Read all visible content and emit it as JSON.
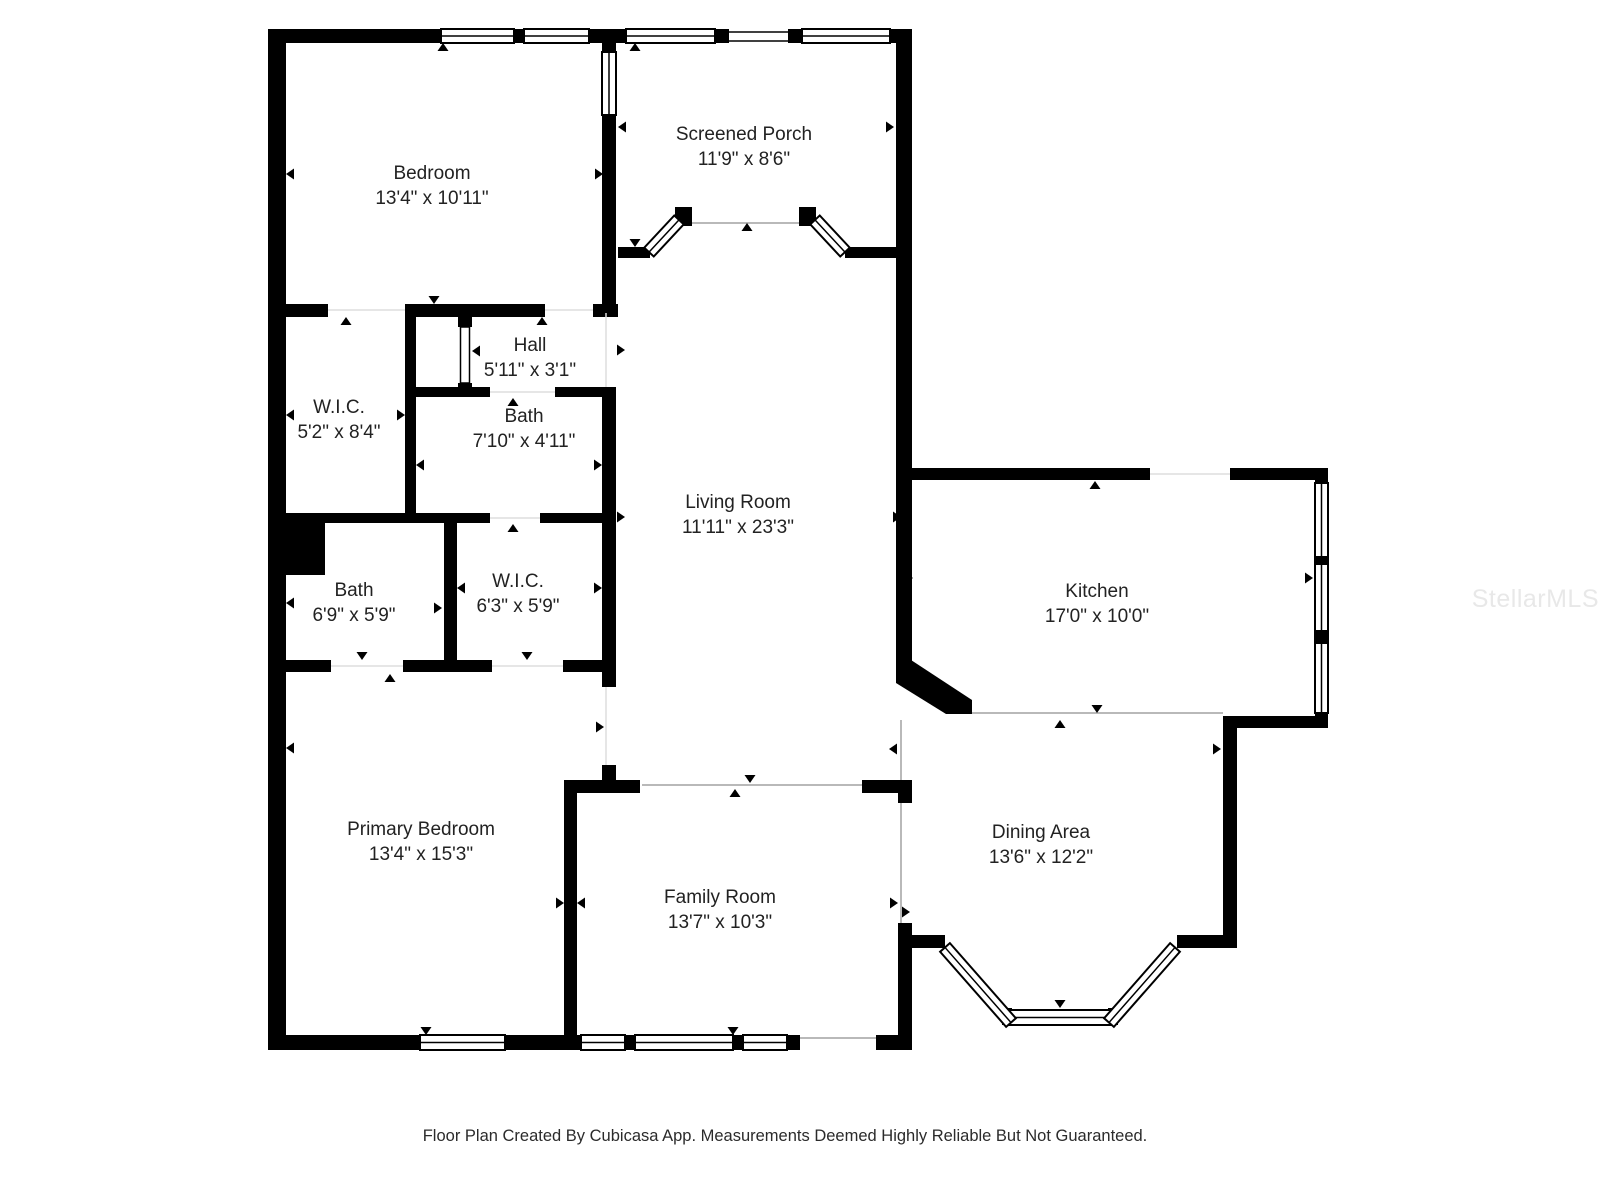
{
  "footer": {
    "text": "Floor Plan Created By Cubicasa App. Measurements Deemed Highly Reliable But Not Guaranteed."
  },
  "watermark": {
    "text": "StellarMLS"
  },
  "rooms": [
    {
      "slug": "bedroom",
      "name": "Bedroom",
      "dims": "13'4\" x 10'11\"",
      "x": 432,
      "y": 186
    },
    {
      "slug": "screened-porch",
      "name": "Screened Porch",
      "dims": "11'9\" x 8'6\"",
      "x": 744,
      "y": 147
    },
    {
      "slug": "hall",
      "name": "Hall",
      "dims": "5'11\" x 3'1\"",
      "x": 530,
      "y": 358
    },
    {
      "slug": "bath-upper",
      "name": "Bath",
      "dims": "7'10\" x 4'11\"",
      "x": 524,
      "y": 429
    },
    {
      "slug": "wic-upper",
      "name": "W.I.C.",
      "dims": "5'2\" x 8'4\"",
      "x": 339,
      "y": 420
    },
    {
      "slug": "living-room",
      "name": "Living Room",
      "dims": "11'11\" x 23'3\"",
      "x": 738,
      "y": 515
    },
    {
      "slug": "kitchen",
      "name": "Kitchen",
      "dims": "17'0\" x 10'0\"",
      "x": 1097,
      "y": 604
    },
    {
      "slug": "bath-lower",
      "name": "Bath",
      "dims": "6'9\" x 5'9\"",
      "x": 354,
      "y": 603
    },
    {
      "slug": "wic-lower",
      "name": "W.I.C.",
      "dims": "6'3\" x 5'9\"",
      "x": 518,
      "y": 594
    },
    {
      "slug": "primary-bedroom",
      "name": "Primary Bedroom",
      "dims": "13'4\" x 15'3\"",
      "x": 421,
      "y": 842
    },
    {
      "slug": "family-room",
      "name": "Family Room",
      "dims": "13'7\" x 10'3\"",
      "x": 720,
      "y": 910
    },
    {
      "slug": "dining-area",
      "name": "Dining Area",
      "dims": "13'6\" x 12'2\"",
      "x": 1041,
      "y": 845
    }
  ],
  "floorplan": {
    "colors": {
      "wall": "#000000",
      "open": "#b9b9b9",
      "thr": "#dedede"
    },
    "walls": [
      [
        268,
        29,
        18,
        1021
      ],
      [
        273,
        29,
        168,
        14
      ],
      [
        514,
        29,
        10,
        14
      ],
      [
        589,
        29,
        29,
        14
      ],
      [
        618,
        29,
        8,
        14
      ],
      [
        715,
        29,
        14,
        14
      ],
      [
        788,
        29,
        14,
        14
      ],
      [
        890,
        29,
        22,
        14
      ],
      [
        896,
        29,
        16,
        640
      ],
      [
        896,
        468,
        254,
        12
      ],
      [
        1230,
        468,
        98,
        12
      ],
      [
        1315,
        468,
        13,
        15
      ],
      [
        1315,
        713,
        13,
        15
      ],
      [
        1223,
        716,
        105,
        12
      ],
      [
        1223,
        716,
        14,
        232
      ],
      [
        1177,
        935,
        60,
        13
      ],
      [
        898,
        935,
        47,
        13
      ],
      [
        1002,
        1008,
        10,
        17
      ],
      [
        1108,
        1008,
        10,
        17
      ],
      [
        898,
        923,
        14,
        127
      ],
      [
        876,
        1035,
        36,
        15
      ],
      [
        268,
        1035,
        152,
        15
      ],
      [
        505,
        1035,
        76,
        15
      ],
      [
        625,
        1035,
        10,
        15
      ],
      [
        733,
        1035,
        10,
        15
      ],
      [
        787,
        1035,
        13,
        15
      ],
      [
        564,
        780,
        13,
        255
      ],
      [
        564,
        780,
        76,
        13
      ],
      [
        862,
        780,
        46,
        13
      ],
      [
        898,
        780,
        14,
        23
      ],
      [
        602,
        43,
        14,
        9
      ],
      [
        602,
        115,
        14,
        132
      ],
      [
        602,
        247,
        14,
        66
      ],
      [
        602,
        387,
        14,
        300
      ],
      [
        602,
        765,
        14,
        28
      ],
      [
        286,
        304,
        42,
        13
      ],
      [
        405,
        304,
        140,
        13
      ],
      [
        593,
        304,
        25,
        13
      ],
      [
        458,
        313,
        14,
        14
      ],
      [
        458,
        383,
        14,
        14
      ],
      [
        405,
        313,
        11,
        200
      ],
      [
        416,
        387,
        74,
        10
      ],
      [
        555,
        387,
        61,
        10
      ],
      [
        325,
        513,
        165,
        10
      ],
      [
        540,
        513,
        76,
        10
      ],
      [
        268,
        513,
        57,
        62
      ],
      [
        444,
        523,
        13,
        137
      ],
      [
        285,
        660,
        46,
        12
      ],
      [
        403,
        660,
        89,
        12
      ],
      [
        563,
        660,
        53,
        12
      ],
      [
        618,
        247,
        32,
        11
      ],
      [
        845,
        247,
        52,
        11
      ],
      [
        675,
        207,
        17,
        19
      ],
      [
        799,
        207,
        17,
        19
      ]
    ],
    "polys": [
      "896,669 911,660 972,700 972,714 946,714 896,683"
    ],
    "windows": [
      [
        441,
        29,
        73,
        14
      ],
      [
        524,
        29,
        65,
        14
      ],
      [
        626,
        29,
        89,
        14
      ],
      [
        802,
        29,
        88,
        14
      ],
      [
        602,
        52,
        14,
        63
      ],
      [
        1315,
        483,
        13,
        230
      ],
      [
        420,
        1035,
        85,
        15
      ],
      [
        581,
        1035,
        44,
        15
      ],
      [
        635,
        1035,
        98,
        15
      ],
      [
        743,
        1035,
        44,
        15
      ],
      [
        1008,
        1010,
        104,
        15
      ]
    ],
    "overlays": [
      [
        1315,
        556,
        13,
        9
      ],
      [
        1315,
        630,
        13,
        14
      ]
    ],
    "diag_windows": [
      [
        664,
        236,
        44,
        -47
      ],
      [
        830,
        236,
        44,
        47
      ],
      [
        978,
        985,
        100,
        48.7
      ],
      [
        1142,
        985,
        100,
        -48.7
      ]
    ],
    "door_leaves": [
      [
        460.5,
        327,
        9,
        56
      ]
    ],
    "lines": [
      [
        901,
        720,
        901,
        780,
        "open",
        2
      ],
      [
        901,
        803,
        901,
        923,
        "open",
        2
      ],
      [
        972,
        713,
        1223,
        713,
        "open",
        2
      ],
      [
        642,
        785,
        862,
        785,
        "open",
        2
      ],
      [
        692,
        223,
        799,
        223,
        "open",
        2
      ],
      [
        800,
        1038,
        876,
        1038,
        "open",
        2
      ],
      [
        729,
        32,
        788,
        32,
        "wall",
        1.5
      ],
      [
        729,
        41,
        788,
        41,
        "wall",
        1.5
      ],
      [
        328,
        310,
        405,
        310,
        "thr",
        1.5
      ],
      [
        545,
        310,
        593,
        310,
        "thr",
        1.5
      ],
      [
        490,
        392,
        555,
        392,
        "thr",
        1.5
      ],
      [
        490,
        518,
        540,
        518,
        "thr",
        1.5
      ],
      [
        331,
        666,
        403,
        666,
        "thr",
        1.5
      ],
      [
        492,
        666,
        563,
        666,
        "thr",
        1.5
      ],
      [
        1150,
        474,
        1230,
        474,
        "thr",
        1.5
      ],
      [
        606,
        313,
        606,
        387,
        "thr",
        1.5
      ],
      [
        606,
        687,
        606,
        765,
        "thr",
        1.5
      ]
    ],
    "markers": [
      [
        443,
        47,
        "up"
      ],
      [
        635,
        47,
        "up"
      ],
      [
        622,
        127,
        "left"
      ],
      [
        890,
        127,
        "right"
      ],
      [
        635,
        243,
        "down"
      ],
      [
        747,
        227,
        "up"
      ],
      [
        290,
        174,
        "left"
      ],
      [
        599,
        174,
        "right"
      ],
      [
        434,
        300,
        "down"
      ],
      [
        346,
        321,
        "up"
      ],
      [
        542,
        321,
        "up"
      ],
      [
        476,
        351,
        "left"
      ],
      [
        621,
        350,
        "right"
      ],
      [
        290,
        415,
        "left"
      ],
      [
        401,
        415,
        "right"
      ],
      [
        420,
        465,
        "left"
      ],
      [
        598,
        465,
        "right"
      ],
      [
        513,
        402,
        "up"
      ],
      [
        513,
        528,
        "up"
      ],
      [
        621,
        517,
        "right"
      ],
      [
        897,
        517,
        "right"
      ],
      [
        909,
        578,
        "right"
      ],
      [
        1309,
        578,
        "right"
      ],
      [
        1095,
        485,
        "up"
      ],
      [
        362,
        656,
        "down"
      ],
      [
        390,
        678,
        "up"
      ],
      [
        527,
        656,
        "down"
      ],
      [
        290,
        603,
        "left"
      ],
      [
        438,
        608,
        "right"
      ],
      [
        461,
        588,
        "left"
      ],
      [
        598,
        588,
        "right"
      ],
      [
        290,
        748,
        "left"
      ],
      [
        600,
        727,
        "right"
      ],
      [
        560,
        903,
        "right"
      ],
      [
        581,
        903,
        "left"
      ],
      [
        894,
        903,
        "right"
      ],
      [
        750,
        779,
        "down"
      ],
      [
        735,
        793,
        "up"
      ],
      [
        893,
        749,
        "left"
      ],
      [
        906,
        912,
        "right"
      ],
      [
        1217,
        749,
        "right"
      ],
      [
        1060,
        724,
        "up"
      ],
      [
        1097,
        709,
        "down"
      ],
      [
        1060,
        1004,
        "down"
      ],
      [
        426,
        1031,
        "down"
      ],
      [
        733,
        1031,
        "down"
      ]
    ]
  }
}
